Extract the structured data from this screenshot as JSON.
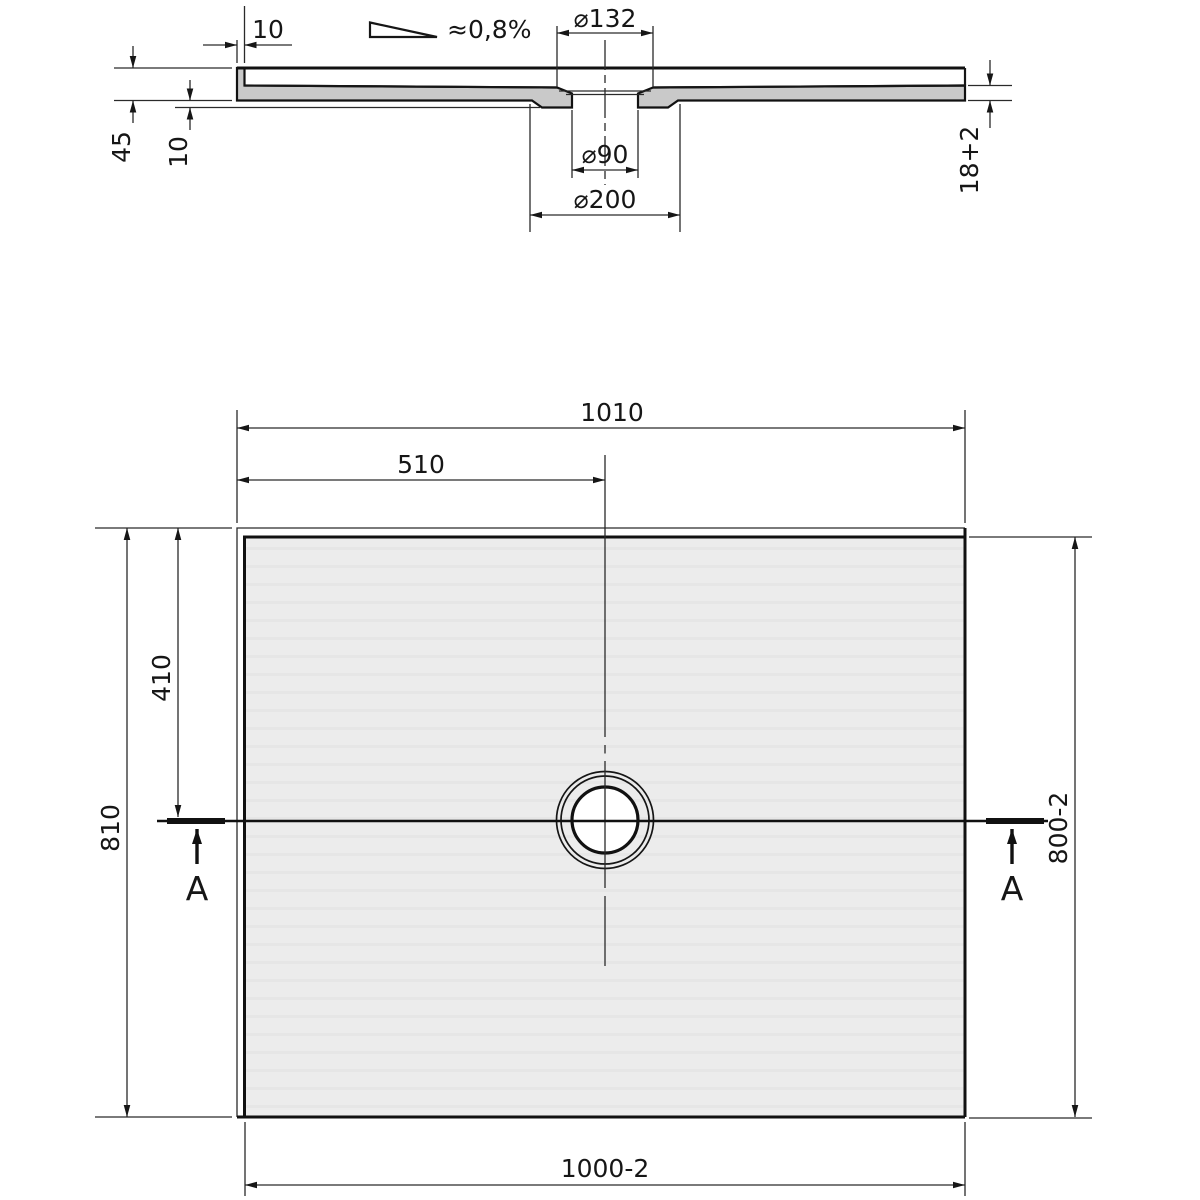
{
  "drawing": {
    "type": "technical-drawing",
    "subject": "rectangular shower tray with offset round floor drain, cross-section A-A above plan view",
    "section": {
      "slope_label": "≈0,8%",
      "dim_wall_thickness": "10",
      "dim_total_height": "45",
      "dim_boss_height": "10",
      "dim_edge_thickness": "18+2",
      "dim_recess_diameter": "⌀132",
      "dim_hole_diameter": "⌀90",
      "dim_boss_diameter": "⌀200"
    },
    "plan": {
      "dim_overall_width": "1010",
      "dim_drain_offset_x": "510",
      "dim_drain_offset_y": "410",
      "dim_overall_depth": "810",
      "dim_inner_depth": "800-2",
      "dim_inner_width": "1000-2",
      "section_marker": "A"
    },
    "colors": {
      "background": "#ffffff",
      "line": "#161616",
      "section_cut_fill": "#c9c9c9",
      "tray_surface_fill": "#ececec"
    }
  }
}
